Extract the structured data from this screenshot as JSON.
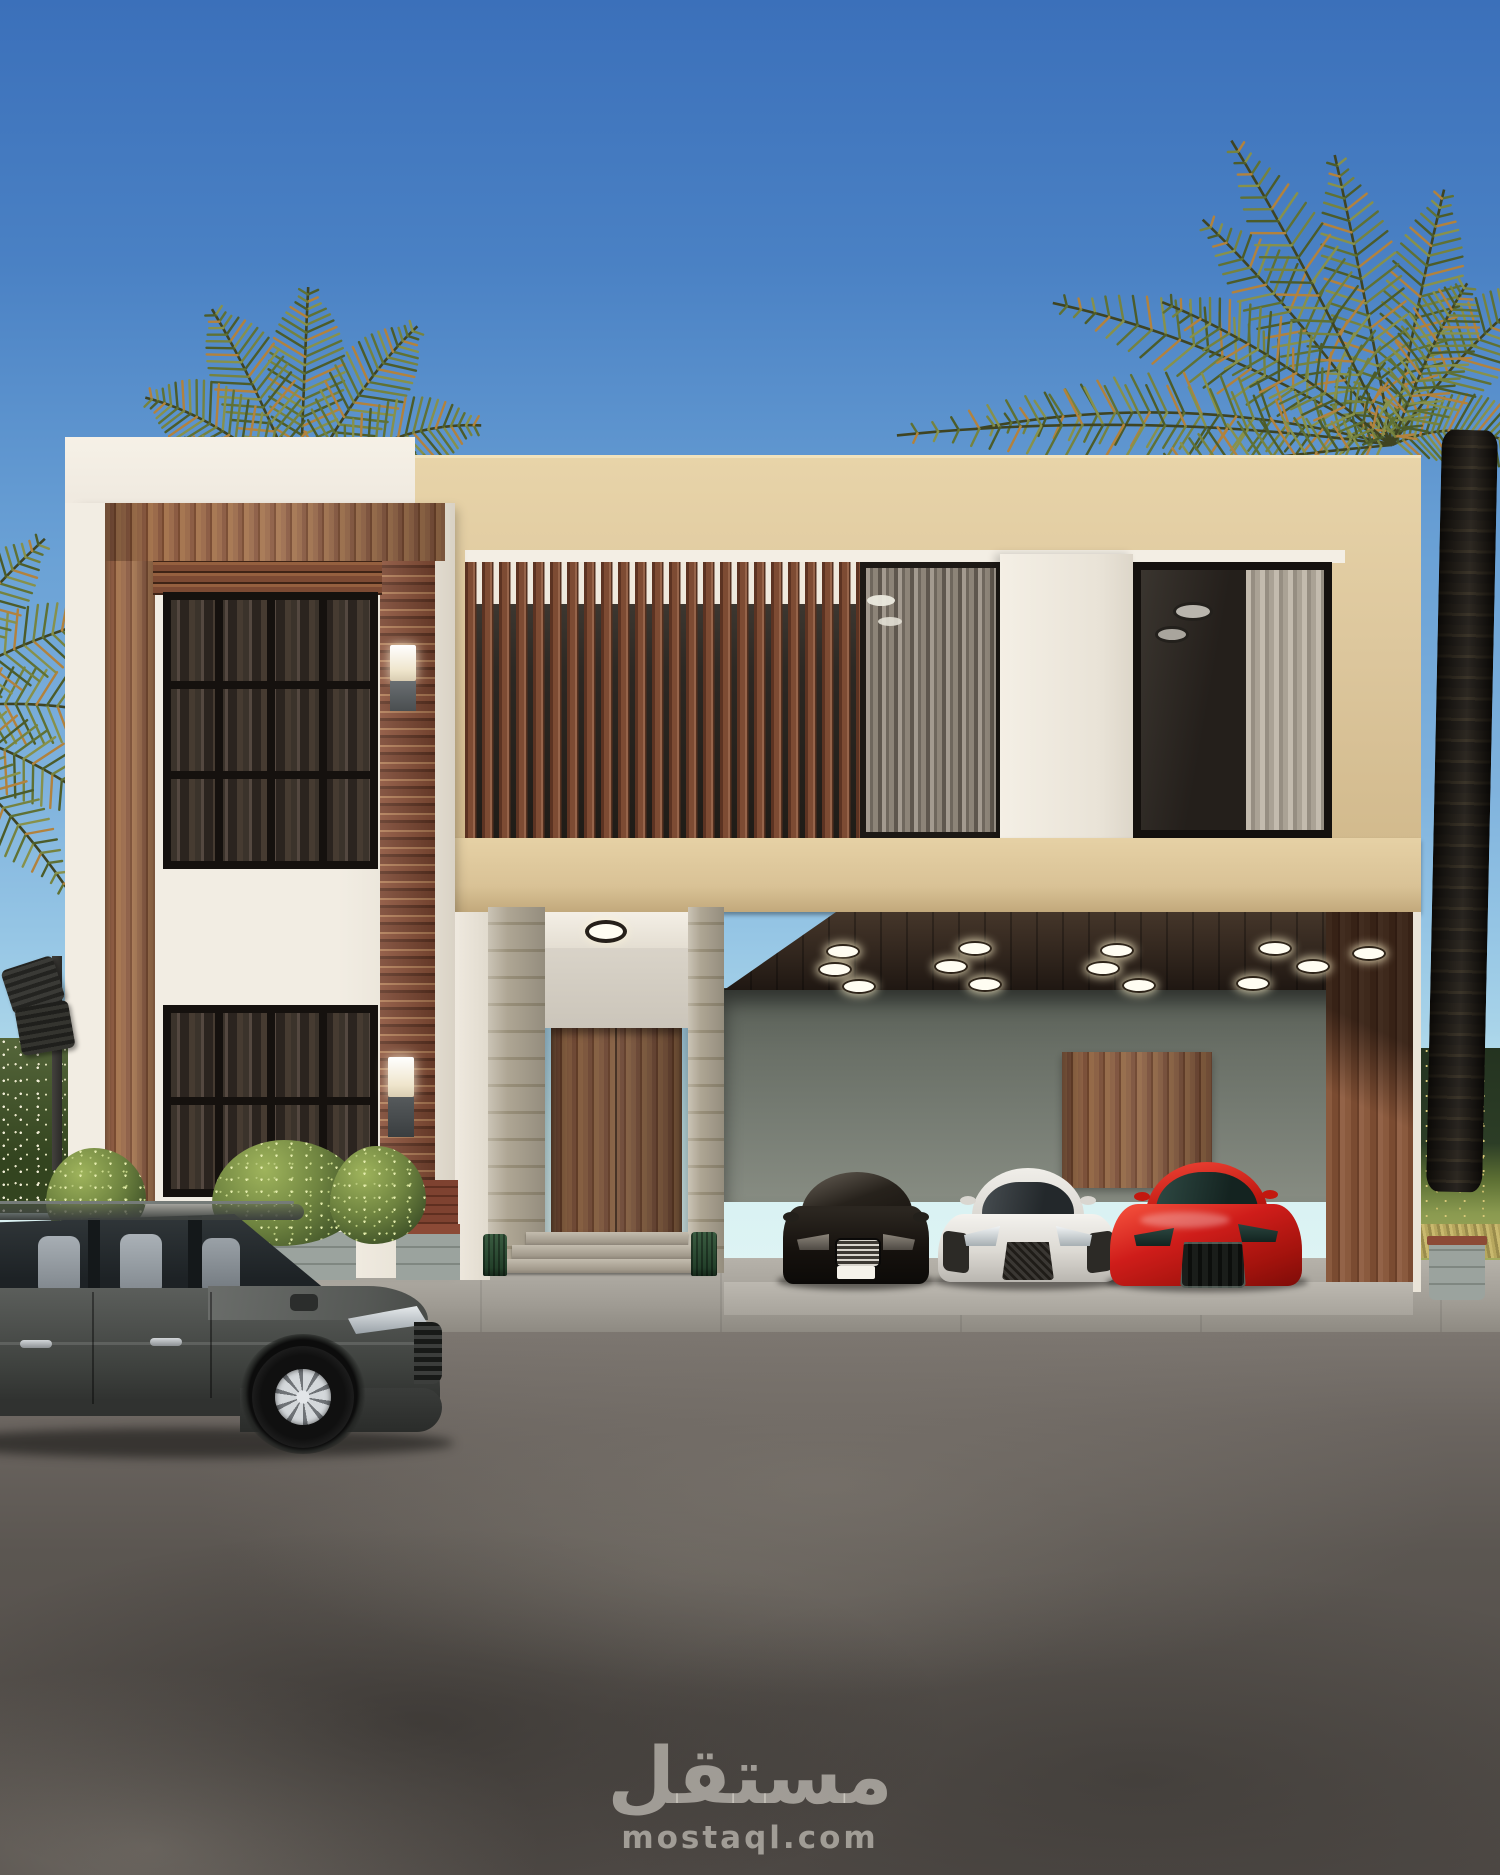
{
  "watermark": {
    "logo_text": "مستقل",
    "site_text": "mostaql.com"
  },
  "palette": {
    "sky_top": "#3b70ba",
    "sky_mid": "#6ba2d6",
    "sky_low": "#96c6e5",
    "horizon": "#c8ebf0",
    "white_wall": "#f1ece2",
    "beige": "#dcc69c",
    "beige_dark": "#c3aa7d",
    "wood": "#8a5a41",
    "wood_dark": "#5e3c2c",
    "wood_light": "#a87a56",
    "glass_dark": "#221e1a",
    "garage_wall": "#767c73",
    "garage_wall_dark": "#565c54",
    "soffit": "#2f241c",
    "stone_pillar": "#b4ab98",
    "stone_block": "#97a09b",
    "brick_red": "#8c4a36",
    "hedge_dark": "#33441f",
    "hedge_light": "#8a9a50",
    "flower": "#f0edd6",
    "frond_green": "#5f7134",
    "frond_olive": "#87914b",
    "frond_orange": "#b2823d",
    "trunk": "#18140f",
    "asphalt": "#5e5954",
    "asphalt_light": "#7d7872",
    "sidewalk": "#a5a19a",
    "suv_gray": "#474a47",
    "car_black": "#15120f",
    "car_white": "#e8e5e0",
    "car_red": "#cf1d1a",
    "glow": "#fffdf2",
    "watermark": "rgba(233,229,221,0.55)"
  }
}
